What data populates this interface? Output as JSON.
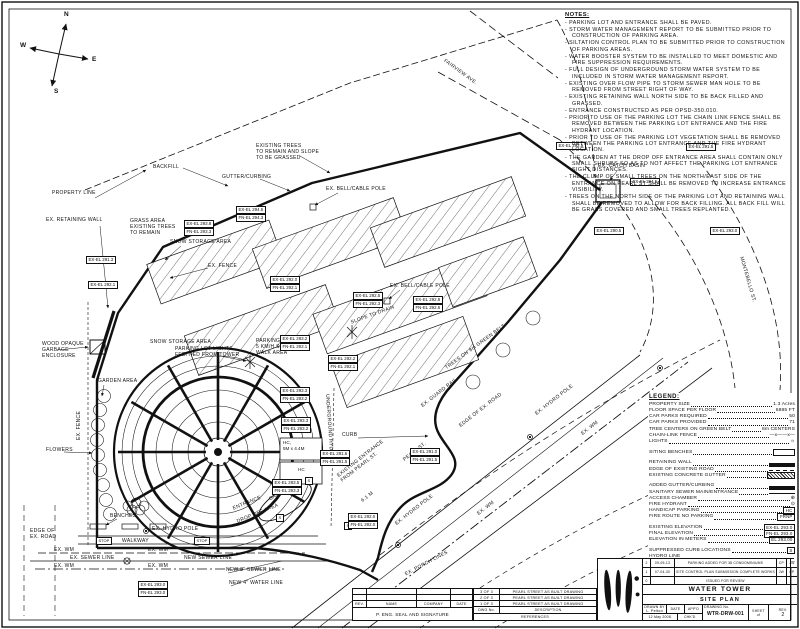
{
  "compass": {
    "n": "N",
    "w": "W",
    "e": "E",
    "s": "S"
  },
  "notes": {
    "heading": "NOTES:",
    "items": [
      "- PARKING LOT AND ENTRANCE SHALL BE PAVED.",
      "- STORM WATER MANAGEMENT REPORT TO BE SUBMITTED PRIOR TO CONSTRUCTION OF PARKING AREA.",
      "- SILTATION CONTROL PLAN TO BE SUBMITTED PRIOR TO CONSTRUCTION OF PARKING AREAS.",
      "- WATER BOOSTER SYSTEM TO BE INSTALLED TO MEET DOMESTIC AND FIRE SUPPRESSION REQUIREMENTS.",
      "- FULL DESIGN OF UNDERGROUND STORM WATER SYSTEM TO BE INCLUDED IN STORM WATER MANAGEMENT REPORT.",
      "- EXISTING OVER FLOW PIPE TO STORM SEWER MAN HOLE TO BE REMOVED FROM STREET RIGHT OF WAY.",
      "- EXISTING RETAINING WALL NORTH SIDE TO BE BACK FILLED AND GRASSED.",
      "- ENTRANCE CONSTRUCTED AS PER OPSD-350.010.",
      "- PRIOR TO USE OF THE PARKING LOT THE CHAIN LINK FENCE SHALL BE REMOVED BETWEEN THE PARKING LOT ENTRANCE AND THE FIRE HYDRANT LOCATION.",
      "- PRIOR TO USE OF THE PARKING LOT VEGETATION SHALL BE REMOVED BETWEEN THE PARKING LOT ENTRANCE AND THE FIRE HYDRANT LOCATION.",
      "- THE GARDEN AT THE DROP OFF ENTRANCE AREA SHALL CONTAIN ONLY SMALL SHRUBS SO AS TO NOT AFFECT THE PARKING LOT ENTRANCE SIGHT DISTANCES.",
      "- THE CLUMP OF SMALL TREES ON THE NORTH/EAST SIDE OF THE ENTRANCE ON PEARL ST SHALL BE REMOVED TO INCREASE ENTRANCE VISIBILITY.",
      "- TREES ON THE NORTH SIDE OF THE PARKING LOT AND RETAINING WALL SHALL BE REMOVED TO ALLOW FOR BACK FILLING. ALL BACK FILL WILL BE GRASS COVERED AND SMALL TREES REPLANTED."
    ]
  },
  "legend": {
    "heading": "LEGEND:",
    "rows": [
      {
        "label": "PROPERTY SIZE",
        "value": "1.3 Acres"
      },
      {
        "label": "FLOOR SPACE PER FLOOR",
        "value": "6885 FT"
      },
      {
        "label": "CAR PARKS REQUIRED",
        "value": "50"
      },
      {
        "label": "CAR PARKS PROVIDED",
        "value": "71"
      },
      {
        "label": "TREE CENTERS ON GREEN BELT",
        "value": "8m CENTERS"
      },
      {
        "label": "CHAIN-LINK FENCE",
        "value": "—x——x—"
      },
      {
        "label": "LIGHTS",
        "value": "☼"
      }
    ],
    "sym_rows": [
      {
        "label": "SITING BENCHES"
      },
      {
        "label": "RETAINING WALL"
      },
      {
        "label": "EDGE OF EXISTING ROAD"
      },
      {
        "label": "EXISTING CONCRETE GUTTER"
      },
      {
        "label": "ADDED GUTTER/CURBING"
      },
      {
        "label": "SANITARY SEWER MAIN/ENTRANCE"
      },
      {
        "label": "ACCESS CHAMBER",
        "value": "⊕"
      },
      {
        "label": "FIRE HYDRANT",
        "value": "⊙"
      },
      {
        "label": "HANDICAP PARKING",
        "value": "HC"
      },
      {
        "label": "FIRE ROUTE NO PARKING",
        "value": "FRNP"
      },
      {
        "label": "EXISTING ELEVATION",
        "value": "EX-EL 293.0"
      },
      {
        "label": "FINAL ELEVATION",
        "value": "FN-EL 293.0"
      },
      {
        "label": "ELEVATION IN METERS",
        "value": "EL 293.00"
      },
      {
        "label": "SUPPRESSED CURB LOCATIONS",
        "value": "S"
      },
      {
        "label": "HYDRO LINE"
      },
      {
        "label": "EXISTING WATER MAIN",
        "value": "— EX. WM —"
      }
    ]
  },
  "map": {
    "property_line": "PROPERTY LINE",
    "retaining_wall": "EX. RETAINING WALL",
    "grass_area": "GRASS AREA\nEXISTING TREES\nTO REMAIN",
    "backfill": "BACKFILL",
    "existing_trees": "EXISTING TREES\nTO REMAIN AND SLOPE\nTO BE GRASSED",
    "gutter_curbing": "GUTTER/CURBING",
    "bell_cable_pole": "EX. BELL/CABLE POLE",
    "snow_storage": "SNOW STORAGE AREA",
    "ex_fence": "EX. FENCE",
    "catch_basin": "EX. CATCH BASIN",
    "fairview": "FAIRVIEW AVE.",
    "montebello": "MONTEBELLO ST.",
    "parking_lot_lights": "PARKING LOT LIGHTS\nFED/TIED FROM TOWER",
    "parking_sign": "PARKING SIGN\n5 KM/H SPEED\nWALK AREA",
    "wood_garbage": "WOOD OPAQUE\nGARBAGE\nENCLOSURE",
    "garden_area": "GARDEN AREA",
    "flowers": "FLOWERS",
    "benches": "BENCHES",
    "hydro_pole": "EX. HYDRO POLE",
    "edge_of_ex_road": "EDGE OF\nEX. ROAD",
    "edge_of_ex_road_1": "EDGE OF EX. ROAD",
    "walkway": "WALKWAY",
    "stop": "STOP",
    "ex_wm": "EX. WM",
    "ex_sewer_line": "EX. SEWER LINE",
    "new_sewer_line": "NEW SEWER LINE",
    "new_8_sewer": "NEW 8\" SEWER LINE",
    "new_4_water": "NEW 4\" WATER LINE",
    "slope_to_drain": "SLOPE TO DRAIN",
    "trees_belt": "TREES ON 8m GREEN BELT",
    "underground_hydro": "UNDERGROUND HYDRO",
    "curb": "CURB",
    "hc_dims": "HC,\n5M x 4.4M",
    "hc": "HC",
    "garden": "GARDEN",
    "entrance": "ENTRANCE",
    "drop_off": "DROP OFF AREA",
    "existing_entrance": "EXISTING ENTRANCE\nFROM PEARL ST.",
    "dim_6_1": "6.1 M",
    "pearl_st": "PEARL ST.",
    "guard_rail": "EX. GUARD RAIL",
    "porch_lines": "EX. PORCH LINES",
    "s": "S",
    "elevations": [
      {
        "a": "EX-EL 292.5"
      },
      {
        "a": "EX-EL 291.5"
      },
      {
        "a": "EX-EL 294.5"
      },
      {
        "a": "EX-EL 290.5"
      },
      {
        "a": "EX-EL 293.0"
      },
      {
        "a": "EX-EL 293.8",
        "b": "FN-EL 293.3"
      },
      {
        "a": "EX-EL 294.5",
        "b": "FN-EL 294.3"
      },
      {
        "a": "EX-EL 291.3"
      },
      {
        "a": "EX-EL 292.1"
      },
      {
        "a": "EX-EL 292.0",
        "b": "FN-EL 292.1"
      },
      {
        "a": "EX-EL 292.5",
        "b": "FN-EL 292.3"
      },
      {
        "a": "EX-EL 292.8",
        "b": "FN-EL 292.6"
      },
      {
        "a": "EX-EL 293.2",
        "b": "FN-EL 293.1"
      },
      {
        "a": "EX-EL 292.2",
        "b": "FN-EL 292.1"
      },
      {
        "a": "EX-EL 293.3",
        "b": "FN-EL 293.2"
      },
      {
        "a": "EX-EL 293.3",
        "b": "FN-EL 293.2"
      },
      {
        "a": "EX-EL 291.6",
        "b": "FN-EL 291.5"
      },
      {
        "a": "EX-EL 293.5",
        "b": "FN-EL 293.3"
      },
      {
        "a": "EX-EL 293.0",
        "b": "FN-EL 293.0"
      },
      {
        "a": "EX-EL 291.0",
        "b": "FN-EL 291.5"
      },
      {
        "a": "EX-EL 292.0",
        "b": "FN-EL 292.0"
      }
    ]
  },
  "title_block": {
    "seal": {
      "col_rev": "REV.",
      "col_name": "NAME",
      "col_company": "COMPANY",
      "col_date": "DATE",
      "seal_text": "P. ENG. SEAL AND SIGNATURE"
    },
    "sheets": [
      {
        "no": "3 OF 3",
        "desc": "PEARL STREET AS BUILT DRAWING"
      },
      {
        "no": "2 OF 3",
        "desc": "PEARL STREET AS BUILT DRAWING"
      },
      {
        "no": "1 OF 3",
        "desc": "PEARL STREET AS BUILT DRAWING"
      }
    ],
    "sheets_footer": {
      "dwg_no": "DWG No.",
      "description": "DESCRIPTION",
      "references": "REFERENCES"
    },
    "revisions": [
      {
        "no": "2",
        "date": "09-05-13",
        "desc": "PARKING ADDED FOR 38 CONDOMINIUMS",
        "by": "CP",
        "app": "JW"
      },
      {
        "no": "1",
        "date": "07-04-30",
        "desc": "SITE CONTROL PLAN SUBMISSION COMPLETE WORKS",
        "by": "JW",
        "app": "CP"
      },
      {
        "no": "0",
        "date": "",
        "desc": "ISSUED FOR REVIEW",
        "by": "",
        "app": ""
      }
    ],
    "title1": "WATER TOWER",
    "title2": "SITE PLAN",
    "drawn_label": "DRAWN BY",
    "drawn": "L. Pelton",
    "date_label": "DATE",
    "date": "12 May 2008",
    "appd_label": "APP'D",
    "chkd_label": "CHK'D",
    "dwg_label": "DRAWING No.",
    "dwg_no": "WTR-DRW-001",
    "sheet_label": "SHEET",
    "of_label": "of",
    "rev_label": "REV.",
    "rev": "2"
  }
}
